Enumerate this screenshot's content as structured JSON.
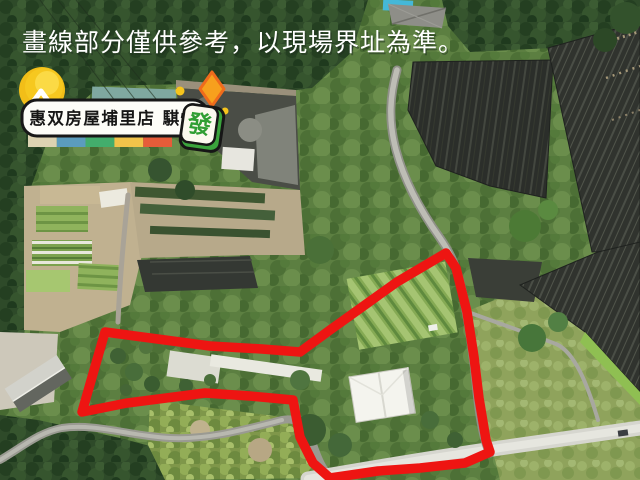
{
  "overlay": {
    "disclaimer": "畫線部分僅供參考，以現場界址為準。",
    "text_color": "#ffffff"
  },
  "badge": {
    "label": "惠双房屋埔里店 騏愷",
    "tile_char": "發",
    "pill_bg": "#fdfdf8",
    "pill_border": "#181818",
    "coin_color": "#f2be18",
    "diamond_color": "#f7a01d",
    "diamond_border": "#ef6b1c",
    "tile_green": "#3aa33c",
    "palette": [
      "#ddd3b2",
      "#5b9cbd",
      "#43ad6c",
      "#f1c34a",
      "#e65c39"
    ]
  },
  "boundary": {
    "color": "#ee1512",
    "path": "M105,332 L210,346 L262,349 L300,352 L330,330 L397,282 L446,253 L456,268 L467,312 L474,357 L479,398 L486,440 L490,452 L465,463 L420,468 L378,471 L330,478 L313,463 L300,437 L293,400 L250,396 L205,393 L127,403 L82,412 Z"
  }
}
